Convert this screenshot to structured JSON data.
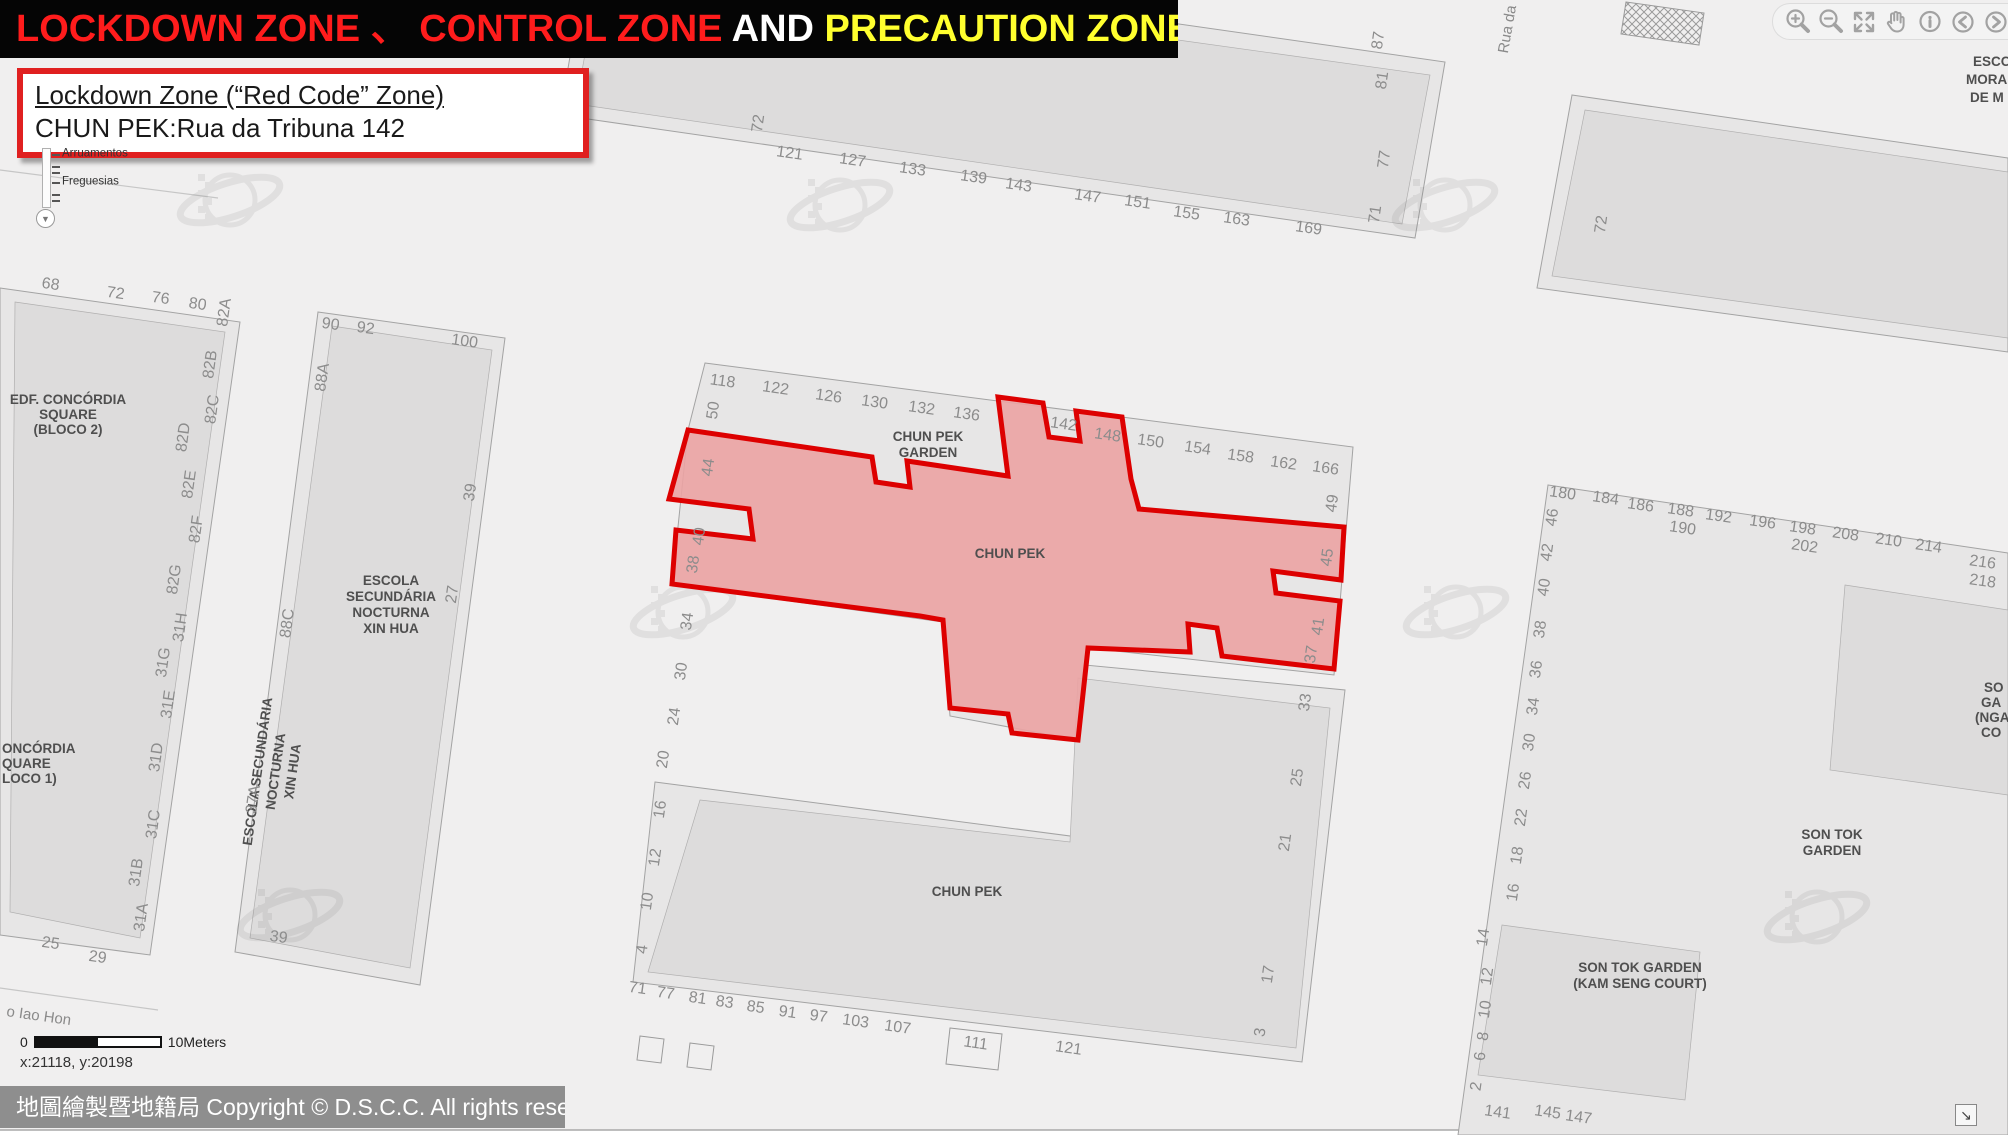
{
  "banner": {
    "segments": [
      {
        "text": "LOCKDOWN ZONE 、 CONTROL ZONE",
        "color": "#ff1c1c"
      },
      {
        "text": " AND ",
        "color": "#ffffff"
      },
      {
        "text": "PRECAUTION ZONE",
        "color": "#ffff2e"
      }
    ]
  },
  "info_box": {
    "title": "Lockdown Zone (“Red Code” Zone)",
    "subtitle": "CHUN PEK:Rua da Tribuna 142"
  },
  "layer_slider": {
    "labels": [
      "Arruamentos",
      "Freguesias"
    ]
  },
  "toolbar": {
    "icons": [
      "zoom-in",
      "zoom-out",
      "full-extent",
      "pan",
      "identify",
      "previous-extent",
      "next-extent"
    ]
  },
  "scale_bar": {
    "start": "0",
    "end": "10Meters"
  },
  "coordinates": "x:21118, y:20198",
  "copyright": "地圖繪製暨地籍局 Copyright © D.S.C.C. All rights reserved",
  "colors": {
    "lockdown_fill": "#eba3a3",
    "lockdown_border": "#dd0000",
    "banner_red": "#ff1c1c",
    "banner_yellow": "#ffff2e"
  },
  "map": {
    "zone_name": "CHUN PEK",
    "labels": [
      {
        "t": "72",
        "x": 763,
        "y": 124,
        "r": -82
      },
      {
        "t": "121",
        "x": 789,
        "y": 158,
        "r": 8
      },
      {
        "t": "127",
        "x": 852,
        "y": 165,
        "r": 8
      },
      {
        "t": "133",
        "x": 912,
        "y": 174,
        "r": 8
      },
      {
        "t": "139",
        "x": 973,
        "y": 182,
        "r": 8
      },
      {
        "t": "143",
        "x": 1018,
        "y": 190,
        "r": 8
      },
      {
        "t": "147",
        "x": 1087,
        "y": 201,
        "r": 8
      },
      {
        "t": "151",
        "x": 1137,
        "y": 207,
        "r": 8
      },
      {
        "t": "155",
        "x": 1186,
        "y": 218,
        "r": 8
      },
      {
        "t": "163",
        "x": 1236,
        "y": 224,
        "r": 8
      },
      {
        "t": "169",
        "x": 1308,
        "y": 233,
        "r": 8
      },
      {
        "t": "87",
        "x": 1383,
        "y": 41,
        "r": -82
      },
      {
        "t": "81",
        "x": 1387,
        "y": 81,
        "r": -82
      },
      {
        "t": "77",
        "x": 1389,
        "y": 160,
        "r": -82
      },
      {
        "t": "71",
        "x": 1380,
        "y": 215,
        "r": -82
      },
      {
        "t": "Rua da",
        "x": 1512,
        "y": 30,
        "r": -80,
        "c": "street"
      },
      {
        "t": "72",
        "x": 1606,
        "y": 225,
        "r": -82
      },
      {
        "t": "ESCO",
        "x": 1973,
        "y": 66,
        "c": "bld",
        "a": "start"
      },
      {
        "t": "MORA",
        "x": 1966,
        "y": 84,
        "c": "bld",
        "a": "start"
      },
      {
        "t": "DE M",
        "x": 1970,
        "y": 102,
        "c": "bld",
        "a": "start"
      },
      {
        "t": "68",
        "x": 50,
        "y": 289,
        "r": 8
      },
      {
        "t": "72",
        "x": 115,
        "y": 298,
        "r": 8
      },
      {
        "t": "76",
        "x": 160,
        "y": 303,
        "r": 8
      },
      {
        "t": "80",
        "x": 197,
        "y": 309,
        "r": 8
      },
      {
        "t": "82A",
        "x": 229,
        "y": 313,
        "r": -82
      },
      {
        "t": "82B",
        "x": 215,
        "y": 365,
        "r": -82
      },
      {
        "t": "82C",
        "x": 217,
        "y": 410,
        "r": -82
      },
      {
        "t": "82D",
        "x": 188,
        "y": 438,
        "r": -82
      },
      {
        "t": "82E",
        "x": 194,
        "y": 485,
        "r": -82
      },
      {
        "t": "82F",
        "x": 201,
        "y": 530,
        "r": -82
      },
      {
        "t": "82G",
        "x": 179,
        "y": 580,
        "r": -82
      },
      {
        "t": "EDF. CONCÓRDIA",
        "x": 68,
        "y": 404,
        "c": "bld"
      },
      {
        "t": "SQUARE",
        "x": 68,
        "y": 419,
        "c": "bld"
      },
      {
        "t": "(BLOCO 2)",
        "x": 68,
        "y": 434,
        "c": "bld"
      },
      {
        "t": "ONCÓRDIA",
        "x": 2,
        "y": 753,
        "c": "bld",
        "a": "start"
      },
      {
        "t": "QUARE",
        "x": 2,
        "y": 768,
        "c": "bld",
        "a": "start"
      },
      {
        "t": "LOCO 1)",
        "x": 2,
        "y": 783,
        "c": "bld",
        "a": "start"
      },
      {
        "t": "31H",
        "x": 185,
        "y": 628,
        "r": -82
      },
      {
        "t": "31G",
        "x": 168,
        "y": 663,
        "r": -82
      },
      {
        "t": "31E",
        "x": 173,
        "y": 705,
        "r": -82
      },
      {
        "t": "31D",
        "x": 161,
        "y": 758,
        "r": -82
      },
      {
        "t": "31C",
        "x": 158,
        "y": 825,
        "r": -82
      },
      {
        "t": "31B",
        "x": 141,
        "y": 873,
        "r": -82
      },
      {
        "t": "31A",
        "x": 146,
        "y": 918,
        "r": -82
      },
      {
        "t": "25",
        "x": 50,
        "y": 948,
        "r": 8
      },
      {
        "t": "29",
        "x": 97,
        "y": 962,
        "r": 8
      },
      {
        "t": "90",
        "x": 330,
        "y": 329,
        "r": 8
      },
      {
        "t": "92",
        "x": 365,
        "y": 333,
        "r": 8
      },
      {
        "t": "100",
        "x": 464,
        "y": 346,
        "r": 8
      },
      {
        "t": "88A",
        "x": 327,
        "y": 378,
        "r": -82
      },
      {
        "t": "88C",
        "x": 292,
        "y": 624,
        "r": -82
      },
      {
        "t": "39",
        "x": 475,
        "y": 493,
        "r": -82
      },
      {
        "t": "27",
        "x": 457,
        "y": 595,
        "r": -82
      },
      {
        "t": "ESCOLA",
        "x": 391,
        "y": 585,
        "c": "bld"
      },
      {
        "t": "SECUNDÁRIA",
        "x": 391,
        "y": 601,
        "c": "bld"
      },
      {
        "t": "NOCTURNA",
        "x": 391,
        "y": 617,
        "c": "bld"
      },
      {
        "t": "XIN HUA",
        "x": 391,
        "y": 633,
        "c": "bld"
      },
      {
        "t": "ESCOLA SECUNDÁRIA",
        "x": 262,
        "y": 772,
        "r": -82,
        "c": "bld"
      },
      {
        "t": "NOCTURNA",
        "x": 280,
        "y": 772,
        "r": -82,
        "c": "bld"
      },
      {
        "t": "XIN HUA",
        "x": 297,
        "y": 772,
        "r": -82,
        "c": "bld"
      },
      {
        "t": "37A",
        "x": 258,
        "y": 800,
        "r": -82
      },
      {
        "t": "39",
        "x": 278,
        "y": 942,
        "r": 8
      },
      {
        "t": "118",
        "x": 722,
        "y": 386,
        "r": 8
      },
      {
        "t": "122",
        "x": 775,
        "y": 393,
        "r": 8
      },
      {
        "t": "126",
        "x": 828,
        "y": 401,
        "r": 8
      },
      {
        "t": "130",
        "x": 874,
        "y": 407,
        "r": 8
      },
      {
        "t": "132",
        "x": 921,
        "y": 413,
        "r": 8
      },
      {
        "t": "136",
        "x": 966,
        "y": 419,
        "r": 8
      },
      {
        "t": "50",
        "x": 718,
        "y": 411,
        "r": -82
      },
      {
        "t": "CHUN PEK",
        "x": 928,
        "y": 441,
        "c": "bld"
      },
      {
        "t": "GARDEN",
        "x": 928,
        "y": 457,
        "c": "bld"
      },
      {
        "t": "142",
        "x": 1063,
        "y": 429,
        "r": 8
      },
      {
        "t": "148",
        "x": 1107,
        "y": 440,
        "r": 8
      },
      {
        "t": "150",
        "x": 1150,
        "y": 446,
        "r": 8
      },
      {
        "t": "154",
        "x": 1197,
        "y": 453,
        "r": 8
      },
      {
        "t": "158",
        "x": 1240,
        "y": 461,
        "r": 8
      },
      {
        "t": "162",
        "x": 1283,
        "y": 468,
        "r": 8
      },
      {
        "t": "166",
        "x": 1325,
        "y": 473,
        "r": 8
      },
      {
        "t": "49",
        "x": 1337,
        "y": 504,
        "r": -82
      },
      {
        "t": "CHUN PEK",
        "x": 1010,
        "y": 558,
        "c": "bld"
      },
      {
        "t": "44",
        "x": 713,
        "y": 468,
        "r": -82
      },
      {
        "t": "40",
        "x": 704,
        "y": 537,
        "r": -82
      },
      {
        "t": "38",
        "x": 698,
        "y": 565,
        "r": -82
      },
      {
        "t": "34",
        "x": 692,
        "y": 622,
        "r": -82
      },
      {
        "t": "30",
        "x": 686,
        "y": 672,
        "r": -82
      },
      {
        "t": "24",
        "x": 679,
        "y": 717,
        "r": -82
      },
      {
        "t": "20",
        "x": 668,
        "y": 760,
        "r": -82
      },
      {
        "t": "45",
        "x": 1332,
        "y": 558,
        "r": -82
      },
      {
        "t": "41",
        "x": 1323,
        "y": 627,
        "r": -82
      },
      {
        "t": "37",
        "x": 1316,
        "y": 655,
        "r": -82
      },
      {
        "t": "33",
        "x": 1310,
        "y": 703,
        "r": -82
      },
      {
        "t": "25",
        "x": 1302,
        "y": 778,
        "r": -82
      },
      {
        "t": "21",
        "x": 1290,
        "y": 843,
        "r": -82
      },
      {
        "t": "17",
        "x": 1273,
        "y": 975,
        "r": -82
      },
      {
        "t": "3",
        "x": 1265,
        "y": 1033,
        "r": -82
      },
      {
        "t": "16",
        "x": 665,
        "y": 810,
        "r": -82
      },
      {
        "t": "12",
        "x": 660,
        "y": 858,
        "r": -82
      },
      {
        "t": "10",
        "x": 652,
        "y": 902,
        "r": -82
      },
      {
        "t": "4",
        "x": 647,
        "y": 950,
        "r": -82
      },
      {
        "t": "71",
        "x": 637,
        "y": 993,
        "r": 8
      },
      {
        "t": "77",
        "x": 665,
        "y": 998,
        "r": 8
      },
      {
        "t": "81",
        "x": 697,
        "y": 1003,
        "r": 8
      },
      {
        "t": "83",
        "x": 724,
        "y": 1007,
        "r": 8
      },
      {
        "t": "85",
        "x": 755,
        "y": 1012,
        "r": 8
      },
      {
        "t": "91",
        "x": 787,
        "y": 1017,
        "r": 8
      },
      {
        "t": "97",
        "x": 818,
        "y": 1021,
        "r": 8
      },
      {
        "t": "103",
        "x": 855,
        "y": 1026,
        "r": 8
      },
      {
        "t": "107",
        "x": 897,
        "y": 1032,
        "r": 8
      },
      {
        "t": "111",
        "x": 975,
        "y": 1048,
        "r": 8
      },
      {
        "t": "121",
        "x": 1068,
        "y": 1053,
        "r": 8
      },
      {
        "t": "CHUN PEK",
        "x": 967,
        "y": 896,
        "c": "bld"
      },
      {
        "t": "180",
        "x": 1562,
        "y": 498,
        "r": 8
      },
      {
        "t": "184",
        "x": 1605,
        "y": 503,
        "r": 8
      },
      {
        "t": "186",
        "x": 1640,
        "y": 510,
        "r": 8
      },
      {
        "t": "188",
        "x": 1680,
        "y": 515,
        "r": 8
      },
      {
        "t": "190",
        "x": 1682,
        "y": 533,
        "r": 8
      },
      {
        "t": "192",
        "x": 1718,
        "y": 521,
        "r": 8
      },
      {
        "t": "196",
        "x": 1762,
        "y": 527,
        "r": 8
      },
      {
        "t": "198",
        "x": 1802,
        "y": 533,
        "r": 8
      },
      {
        "t": "202",
        "x": 1804,
        "y": 551,
        "r": 8
      },
      {
        "t": "208",
        "x": 1845,
        "y": 539,
        "r": 8
      },
      {
        "t": "210",
        "x": 1888,
        "y": 545,
        "r": 8
      },
      {
        "t": "214",
        "x": 1928,
        "y": 551,
        "r": 8
      },
      {
        "t": "216",
        "x": 1982,
        "y": 567,
        "r": 8
      },
      {
        "t": "218",
        "x": 1982,
        "y": 586,
        "r": 8
      },
      {
        "t": "46",
        "x": 1557,
        "y": 518,
        "r": -82
      },
      {
        "t": "42",
        "x": 1552,
        "y": 553,
        "r": -82
      },
      {
        "t": "40",
        "x": 1549,
        "y": 588,
        "r": -82
      },
      {
        "t": "38",
        "x": 1545,
        "y": 630,
        "r": -82
      },
      {
        "t": "36",
        "x": 1541,
        "y": 670,
        "r": -82
      },
      {
        "t": "34",
        "x": 1538,
        "y": 707,
        "r": -82
      },
      {
        "t": "30",
        "x": 1534,
        "y": 743,
        "r": -82
      },
      {
        "t": "26",
        "x": 1530,
        "y": 781,
        "r": -82
      },
      {
        "t": "22",
        "x": 1526,
        "y": 818,
        "r": -82
      },
      {
        "t": "18",
        "x": 1522,
        "y": 856,
        "r": -82
      },
      {
        "t": "16",
        "x": 1518,
        "y": 893,
        "r": -82
      },
      {
        "t": "14",
        "x": 1488,
        "y": 938,
        "r": -82
      },
      {
        "t": "12",
        "x": 1492,
        "y": 977,
        "r": -82
      },
      {
        "t": "10",
        "x": 1490,
        "y": 1010,
        "r": -82
      },
      {
        "t": "8",
        "x": 1488,
        "y": 1037,
        "r": -82
      },
      {
        "t": "6",
        "x": 1485,
        "y": 1057,
        "r": -82
      },
      {
        "t": "2",
        "x": 1481,
        "y": 1087,
        "r": -82
      },
      {
        "t": "141",
        "x": 1497,
        "y": 1117,
        "r": 8
      },
      {
        "t": "145",
        "x": 1547,
        "y": 1117,
        "r": 8
      },
      {
        "t": "147",
        "x": 1578,
        "y": 1122,
        "r": 8
      },
      {
        "t": "SON TOK",
        "x": 1832,
        "y": 839,
        "c": "bld"
      },
      {
        "t": "GARDEN",
        "x": 1832,
        "y": 855,
        "c": "bld"
      },
      {
        "t": "SON TOK GARDEN",
        "x": 1640,
        "y": 972,
        "c": "bld"
      },
      {
        "t": "(KAM SENG COURT)",
        "x": 1640,
        "y": 988,
        "c": "bld"
      },
      {
        "t": "SO",
        "x": 1984,
        "y": 692,
        "c": "bld",
        "a": "start"
      },
      {
        "t": "GA",
        "x": 1981,
        "y": 707,
        "c": "bld",
        "a": "start"
      },
      {
        "t": "(NGA",
        "x": 1975,
        "y": 722,
        "c": "bld",
        "a": "start"
      },
      {
        "t": "CO",
        "x": 1981,
        "y": 737,
        "c": "bld",
        "a": "start"
      },
      {
        "t": "o Iao Hon",
        "x": 6,
        "y": 1016,
        "r": 8,
        "c": "street",
        "a": "start"
      }
    ]
  }
}
